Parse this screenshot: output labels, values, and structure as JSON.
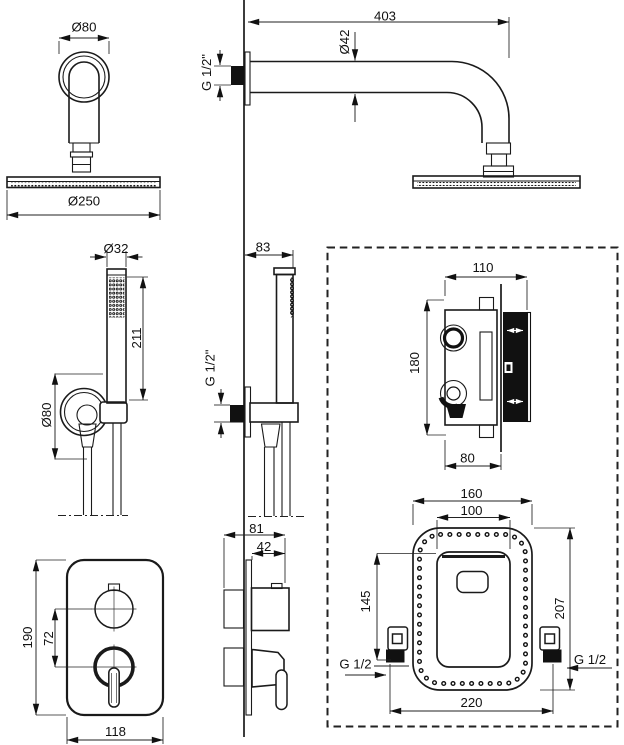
{
  "title": "Concealed shower set installation drawing",
  "views": {
    "overhead_shower_top": {
      "flange_diameter": "Ø80",
      "head_diameter": "Ø250"
    },
    "shower_arm_side": {
      "length": "403",
      "tube_diameter": "Ø42",
      "thread": "G 1/2\""
    },
    "hand_shower_front": {
      "handle_diameter": "Ø32",
      "handle_length": "211",
      "wall_plate_diameter": "Ø80"
    },
    "hand_shower_side": {
      "depth": "83",
      "thread": "G 1/2\""
    },
    "mixer_valve_side": {
      "width": "110",
      "height": "180",
      "depth_to_wall": "80"
    },
    "trim_plate_front": {
      "height": "190",
      "knob_spacing": "72",
      "width": "118"
    },
    "trim_plate_side": {
      "total_depth": "81",
      "knob_depth": "42"
    },
    "mounting_box_front": {
      "body_width": "160",
      "plate_width": "100",
      "plate_height": "145",
      "body_height": "207",
      "total_width": "220",
      "thread_left": "G 1/2",
      "thread_right": "G 1/2"
    }
  }
}
